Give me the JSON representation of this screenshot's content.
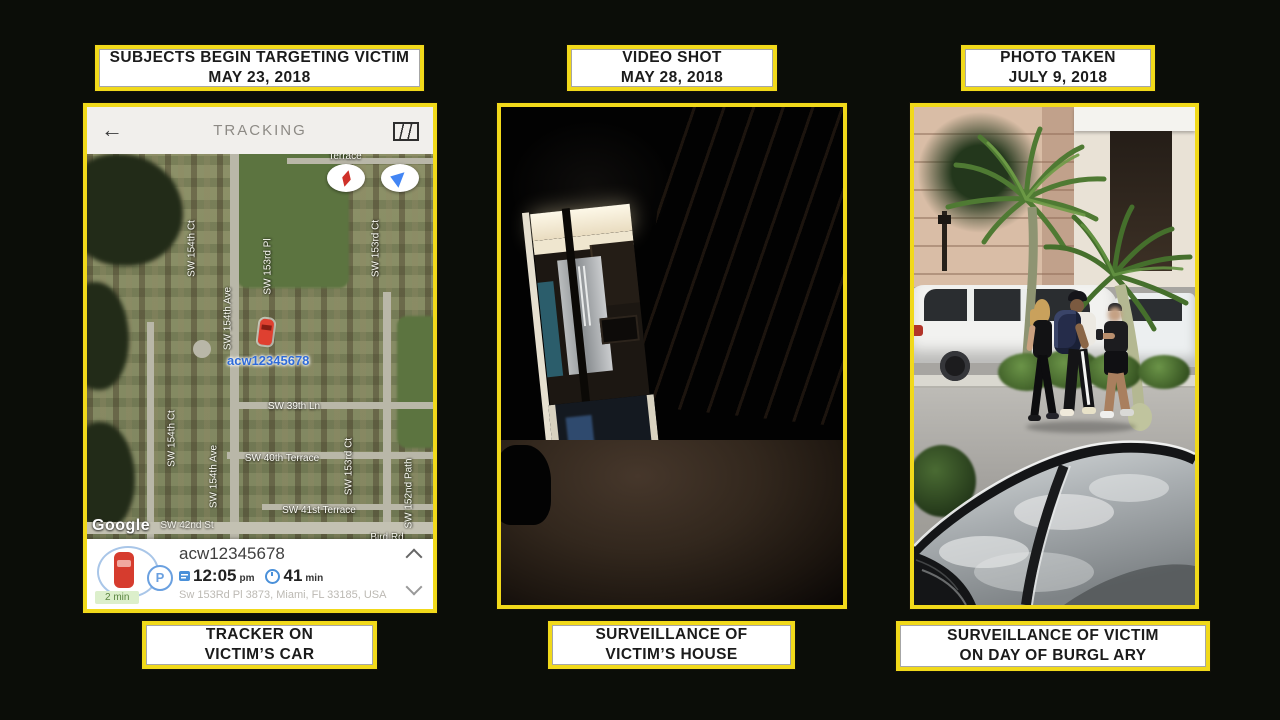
{
  "colors": {
    "yellow": "#f1d91a",
    "background": "#0b0d08"
  },
  "labels": {
    "top_left": [
      "SUBJECTS BEGIN TARGETING VICTIM",
      "MAY 23, 2018"
    ],
    "top_middle": [
      "VIDEO SHOT",
      "MAY 28, 2018"
    ],
    "top_right": [
      "PHOTO TAKEN",
      "JULY 9, 2018"
    ],
    "bottom_left": [
      "TRACKER ON",
      "VICTIM’S CAR"
    ],
    "bottom_middle": [
      "SURVEILLANCE OF",
      "VICTIM’S HOUSE"
    ],
    "bottom_right": [
      "SURVEILLANCE OF VICTIM",
      "ON DAY OF BURGL ARY"
    ]
  },
  "phone": {
    "header": {
      "back_glyph": "←",
      "title": "TRACKING"
    },
    "map": {
      "streets": [
        "SW 154th Ct",
        "SW 153rd Pl",
        "SW 153rd Ct",
        "SW 154th Ave",
        "SW 39th Ln",
        "SW 154th Ct",
        "SW 154th Ave",
        "SW 40th Terrace",
        "SW 41st Terrace",
        "SW 153rd Ct",
        "SW 152nd Path",
        "Terrace",
        "SW 42nd St",
        "Bird Rd"
      ],
      "marker_label": "acw12345678",
      "logo": "Google"
    },
    "card": {
      "title": "acw12345678",
      "time": "12:05",
      "time_unit": "pm",
      "duration": "41",
      "duration_unit": "min",
      "address": "Sw 153Rd Pl 3873, Miami, FL 33185, USA",
      "eta": "2 min",
      "parking": "P"
    }
  },
  "icons": {
    "back": "arrow-left",
    "map_layers": "folded-map",
    "compass": "compass-pill",
    "navigation": "navigation-pill",
    "depart": "depart-time",
    "clock": "clock",
    "chevron_up": "collapse",
    "chevron_down": "expand",
    "car_marker": "tracked-car"
  }
}
